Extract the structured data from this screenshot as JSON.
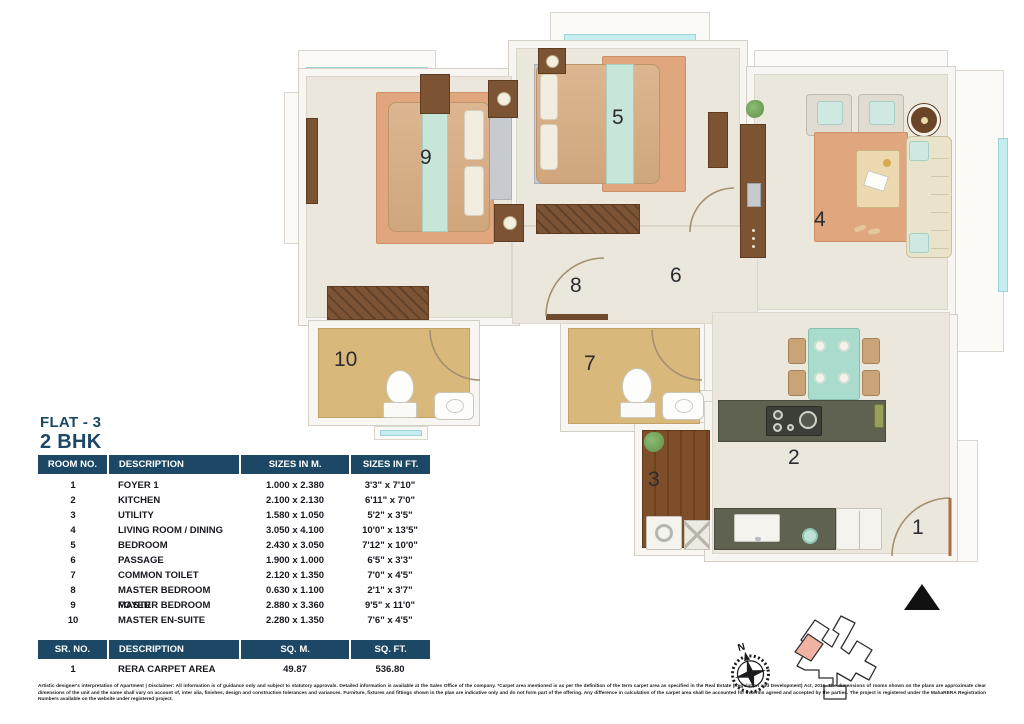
{
  "title": {
    "flat": "FLAT - 3",
    "bhk": "2 BHK"
  },
  "room_table": {
    "headers": [
      "ROOM NO.",
      "DESCRIPTION",
      "SIZES IN M.",
      "SIZES IN FT."
    ],
    "rows": [
      {
        "no": "1",
        "desc": "FOYER 1",
        "m": "1.000 x 2.380",
        "ft": "3'3\" x 7'10\""
      },
      {
        "no": "2",
        "desc": "KITCHEN",
        "m": "2.100 x 2.130",
        "ft": "6'11\" x 7'0\""
      },
      {
        "no": "3",
        "desc": "UTILITY",
        "m": "1.580 x 1.050",
        "ft": "5'2\" x 3'5\""
      },
      {
        "no": "4",
        "desc": "LIVING ROOM / DINING",
        "m": "3.050 x 4.100",
        "ft": "10'0\" x 13'5\""
      },
      {
        "no": "5",
        "desc": "BEDROOM",
        "m": "2.430 x 3.050",
        "ft": "7'12\" x 10'0\""
      },
      {
        "no": "6",
        "desc": "PASSAGE",
        "m": "1.900 x 1.000",
        "ft": "6'5\" x 3'3\""
      },
      {
        "no": "7",
        "desc": "COMMON TOILET",
        "m": "2.120 x 1.350",
        "ft": "7'0\" x 4'5\""
      },
      {
        "no": "8",
        "desc": "MASTER BEDROOM FOYER",
        "m": "0.630 x 1.100",
        "ft": "2'1\" x 3'7\""
      },
      {
        "no": "9",
        "desc": "MASTER BEDROOM",
        "m": "2.880 x 3.360",
        "ft": "9'5\" x 11'0\""
      },
      {
        "no": "10",
        "desc": "MASTER EN-SUITE",
        "m": "2.280 x 1.350",
        "ft": "7'6\" x 4'5\""
      }
    ]
  },
  "area_table": {
    "headers": [
      "SR. NO.",
      "DESCRIPTION",
      "SQ. M.",
      "SQ. FT."
    ],
    "rows": [
      {
        "no": "1",
        "desc": "RERA CARPET AREA",
        "sqm": "49.87",
        "sqft": "536.80"
      }
    ]
  },
  "plan": {
    "rooms": [
      {
        "label": "1"
      },
      {
        "label": "2"
      },
      {
        "label": "3"
      },
      {
        "label": "4"
      },
      {
        "label": "5"
      },
      {
        "label": "6"
      },
      {
        "label": "7"
      },
      {
        "label": "8"
      },
      {
        "label": "9"
      },
      {
        "label": "10"
      }
    ],
    "compass_label": "N"
  },
  "colors": {
    "accent_navy": "#1c4866",
    "rug_salmon": "#e0a77f",
    "window_teal": "#c6edf0",
    "keyplan_highlight": "#f0b2a3"
  },
  "disclaimer": "Artistic designer's interpretation of Apartment | Disclaimer: All information is of guidance only and subject to statutory approvals. Detailed information is available at the Sales Office of the company. *Carpet area mentioned is as per the definition of the term carpet area as specified in the Real Estate (Regulation and Development) Act, 2016. The dimensions of rooms shown on the plans are approximate clear dimensions of the unit and the same shall vary on account of, inter alia, finishes, design and construction tolerances and variances. Furniture, fixtures and fittings shown in the plan are indicative only and do not form part of the offering. Any difference in calculation of the carpet area shall be accounted for in terms agreed and accepted by the parties. The project is registered under the MahaRERA Registration Numbers available on the website under registered project."
}
